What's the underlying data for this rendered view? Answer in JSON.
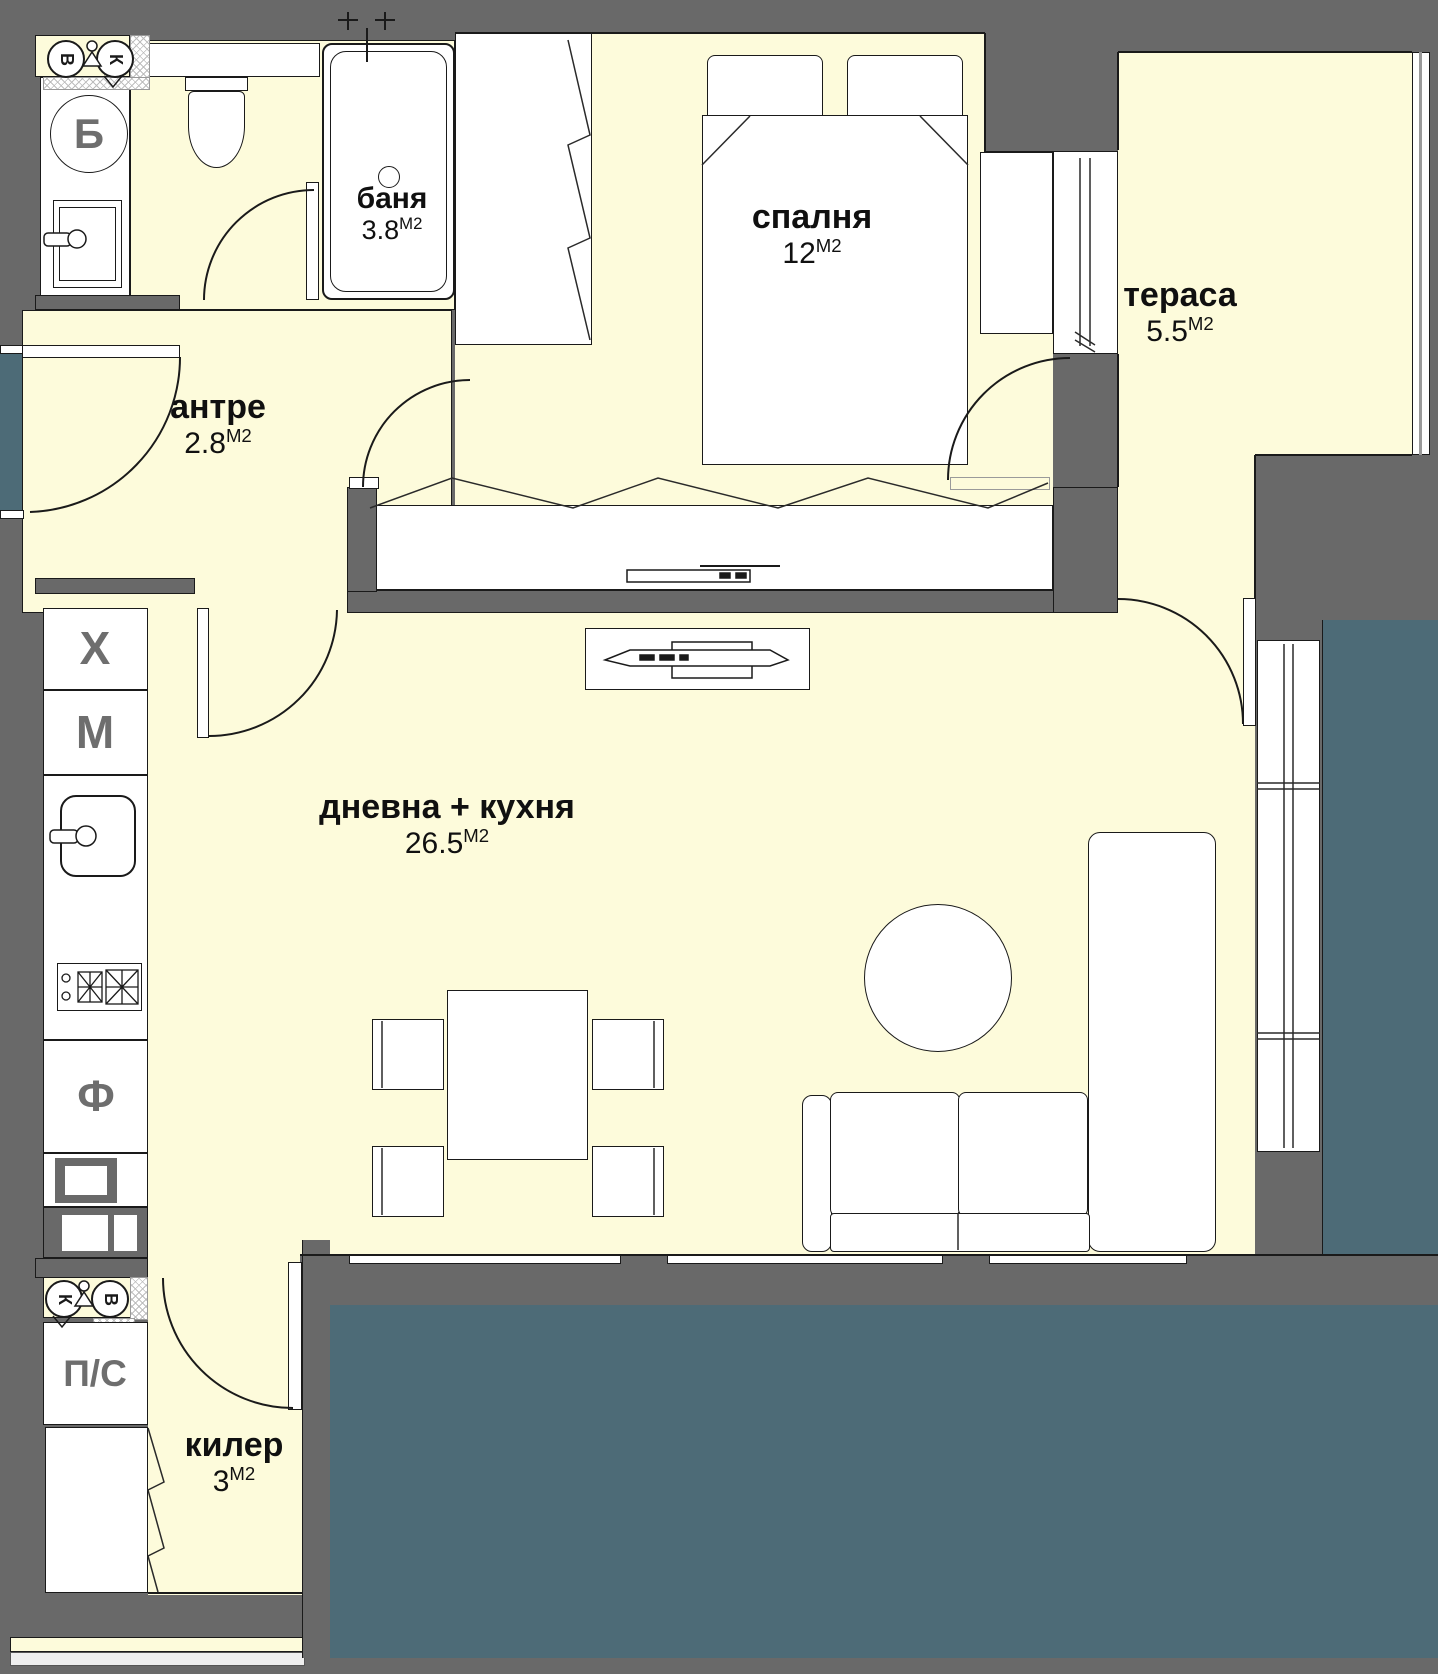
{
  "plan": {
    "rooms": [
      {
        "name": "баня",
        "area": "3.8",
        "unit": "М2"
      },
      {
        "name": "спалня",
        "area": "12",
        "unit": "М2"
      },
      {
        "name": "тераса",
        "area": "5.5",
        "unit": "М2"
      },
      {
        "name": "антре",
        "area": "2.8",
        "unit": "М2"
      },
      {
        "name": "дневна + кухня",
        "area": "26.5",
        "unit": "М2"
      },
      {
        "name": "килер",
        "area": "3",
        "unit": "М2"
      }
    ],
    "appliances": {
      "boiler": "Б",
      "fridge": "Х",
      "dishwasher": "М",
      "oven": "Ф",
      "washer_dryer": "П/С"
    },
    "utility_symbols": {
      "water": "В",
      "sewer": "К"
    },
    "colors": {
      "floor": "#fdfbdb",
      "wall": "#696969",
      "exterior": "#4d6b77",
      "furniture_fill": "#ffffff",
      "line": "#1a1a1a",
      "letter_gray": "#6e6e6e"
    }
  }
}
